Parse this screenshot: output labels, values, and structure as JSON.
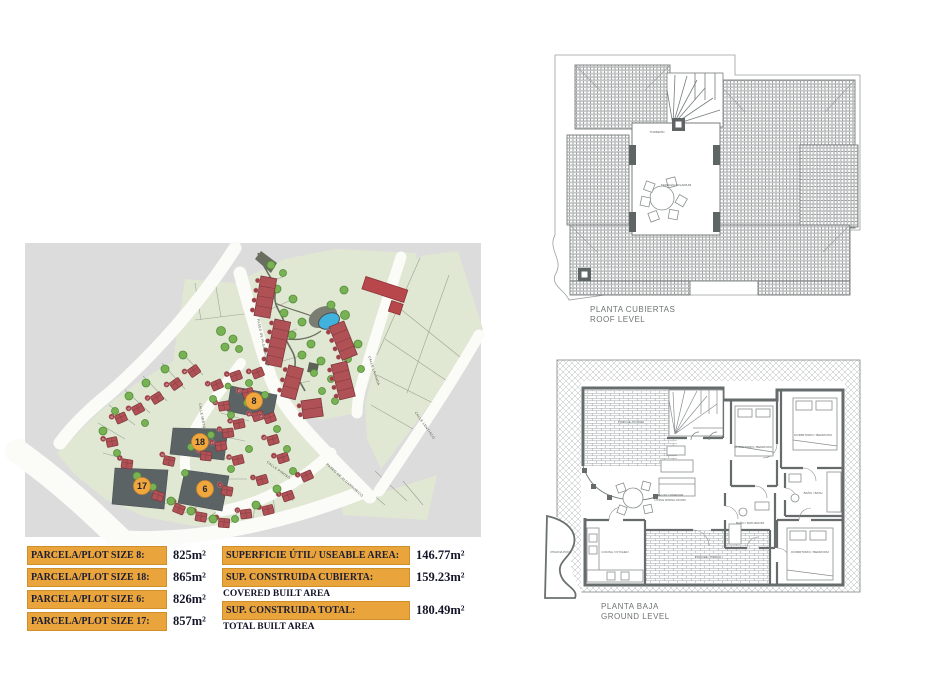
{
  "tables": {
    "plots": {
      "rows": [
        {
          "label": "PARCELA/PLOT SIZE 8:",
          "value": "825m²"
        },
        {
          "label": "PARCELA/PLOT SIZE 18:",
          "value": "865m²"
        },
        {
          "label": "PARCELA/PLOT SIZE 6:",
          "value": "826m²"
        },
        {
          "label": "PARCELA/PLOT SIZE 17:",
          "value": "857m²"
        }
      ]
    },
    "areas": {
      "rows": [
        {
          "label": "SUPERFICIE ÚTIL/ USEABLE AREA:",
          "value": "146.77m²",
          "sublabel": ""
        },
        {
          "label": "SUP. CONSTRUIDA CUBIERTA:",
          "value": "159.23m²",
          "sublabel": "COVERED BUILT AREA"
        },
        {
          "label": "SUP. CONSTRUIDA TOTAL:",
          "value": "180.49m²",
          "sublabel": "TOTAL BUILT AREA"
        }
      ]
    }
  },
  "plans": {
    "roof": {
      "title": "PLANTA CUBIERTAS",
      "subtitle": "ROOF LEVEL",
      "labels": [
        {
          "t": "TORREÓN",
          "x": 112,
          "y": 83
        },
        {
          "t": "TERRAZA SOLARIUM",
          "x": 131,
          "y": 136
        }
      ]
    },
    "ground": {
      "title": "PLANTA BAJA",
      "subtitle": "GROUND LEVEL",
      "rooms": [
        {
          "t": "PORCHE / PORCH",
          "x": 86,
          "y": 75
        },
        {
          "t": "SALON COMEDOR",
          "x": 125,
          "y": 148
        },
        {
          "t": "LIVING DINING ROOM",
          "x": 125,
          "y": 153
        },
        {
          "t": "DORMITORIO / BEDROOM",
          "x": 208,
          "y": 100
        },
        {
          "t": "DORMITORIO / BEDROOM",
          "x": 268,
          "y": 88
        },
        {
          "t": "DORMITORIO / BEDROOM",
          "x": 265,
          "y": 205
        },
        {
          "t": "BAÑO / BATHROOM",
          "x": 205,
          "y": 176
        },
        {
          "t": "BAÑO / BATH",
          "x": 268,
          "y": 146
        },
        {
          "t": "COCINA / KITCHEN",
          "x": 70,
          "y": 205
        },
        {
          "t": "PORCHE / PORCH",
          "x": 163,
          "y": 210
        },
        {
          "t": "PISCINA POOL",
          "x": 16,
          "y": 205
        }
      ]
    }
  },
  "site_map": {
    "colors": {
      "bg": "#dcdcdc",
      "green": "#e0e7d2",
      "road": "#fbfbf8",
      "house": "#b05156",
      "houseStroke": "#7d383d",
      "tree": "#79b254",
      "treeStroke": "#518d37",
      "plotDark": "#5c6365",
      "badge": "#f0a73e",
      "badgeEdge": "#c9862c",
      "badgeText": "#23232f",
      "numCircle": "#9c4046",
      "pool": "#3fb3dd",
      "path": "#6a6e60"
    },
    "streets": [
      {
        "t": "PASEO DE ALGARROBICO",
        "x": 237,
        "y": 100,
        "r": 78
      },
      {
        "t": "PASEO DE ALGARROBICO",
        "x": 319,
        "y": 238,
        "r": 42
      },
      {
        "t": "CALLE LAVANDA",
        "x": 348,
        "y": 128,
        "r": 72
      },
      {
        "t": "CALLE LENTISCO",
        "x": 399,
        "y": 183,
        "r": 55
      },
      {
        "t": "CALLE MIRTO",
        "x": 176,
        "y": 173,
        "r": 80
      },
      {
        "t": "CALLE PINOSO",
        "x": 253,
        "y": 228,
        "r": 36
      }
    ],
    "highlighted_plots": [
      {
        "n": "8",
        "cx": 229,
        "cy": 158,
        "poly": "206,143 252,152 247,177 202,168"
      },
      {
        "n": "18",
        "cx": 175,
        "cy": 199,
        "poly": "148,185 203,186 199,217 145,211"
      },
      {
        "n": "6",
        "cx": 180,
        "cy": 246,
        "poly": "160,227 204,233 197,268 153,260"
      },
      {
        "n": "17",
        "cx": 117,
        "cy": 243,
        "poly": "90,225 143,227 139,266 87,261"
      }
    ],
    "houses": [
      [
        169,
        128,
        -35,
        "26"
      ],
      [
        151,
        141,
        -35,
        "25"
      ],
      [
        132,
        155,
        -32,
        "24"
      ],
      [
        113,
        166,
        -28,
        "23"
      ],
      [
        96,
        175,
        -24,
        "22"
      ],
      [
        87,
        199,
        -12,
        "21"
      ],
      [
        102,
        221,
        8,
        "5"
      ],
      [
        133,
        253,
        18,
        "6"
      ],
      [
        154,
        266,
        22,
        "10"
      ],
      [
        176,
        274,
        10,
        "11"
      ],
      [
        199,
        280,
        4,
        "9"
      ],
      [
        221,
        271,
        -8,
        "27"
      ],
      [
        243,
        267,
        -14,
        "7"
      ],
      [
        263,
        253,
        -20,
        "3"
      ],
      [
        237,
        237,
        -16,
        "2"
      ],
      [
        282,
        233,
        -24,
        "1"
      ],
      [
        213,
        217,
        -14,
        "19"
      ],
      [
        196,
        203,
        -10,
        "13"
      ],
      [
        144,
        218,
        12,
        "16"
      ],
      [
        181,
        213,
        6,
        "18"
      ],
      [
        203,
        190,
        -8,
        "12"
      ],
      [
        214,
        181,
        -12,
        "15"
      ],
      [
        233,
        173,
        -18,
        "14"
      ],
      [
        199,
        163,
        -10,
        "20"
      ],
      [
        211,
        133,
        -20,
        "4"
      ],
      [
        192,
        142,
        -24,
        "17"
      ],
      [
        233,
        130,
        -22,
        "8"
      ],
      [
        245,
        175,
        -20,
        "14"
      ],
      [
        248,
        197,
        -16,
        "19"
      ],
      [
        258,
        215,
        -18,
        "2"
      ],
      [
        223,
        150,
        -16,
        "13"
      ],
      [
        202,
        248,
        10,
        "4"
      ]
    ],
    "trees": [
      [
        158,
        112,
        4
      ],
      [
        140,
        126,
        4
      ],
      [
        121,
        140,
        4
      ],
      [
        104,
        153,
        4
      ],
      [
        90,
        168,
        3.5
      ],
      [
        78,
        188,
        4
      ],
      [
        92,
        210,
        3.5
      ],
      [
        112,
        233,
        4
      ],
      [
        128,
        244,
        3.5
      ],
      [
        146,
        258,
        4
      ],
      [
        166,
        268,
        4
      ],
      [
        188,
        276,
        4
      ],
      [
        210,
        276,
        3.5
      ],
      [
        231,
        262,
        4
      ],
      [
        252,
        246,
        4
      ],
      [
        268,
        228,
        3.5
      ],
      [
        224,
        206,
        3.5
      ],
      [
        206,
        226,
        3.5
      ],
      [
        186,
        192,
        3.5
      ],
      [
        166,
        204,
        3.5
      ],
      [
        206,
        172,
        3.5
      ],
      [
        188,
        156,
        3.5
      ],
      [
        222,
        160,
        3.5
      ],
      [
        240,
        152,
        3.5
      ],
      [
        224,
        140,
        3.5
      ],
      [
        252,
        186,
        3.5
      ],
      [
        262,
        206,
        3.5
      ],
      [
        203,
        143,
        3
      ],
      [
        160,
        230,
        3.5
      ],
      [
        120,
        180,
        3.5
      ],
      [
        196,
        88,
        4.5
      ],
      [
        208,
        96,
        4
      ],
      [
        200,
        104,
        4
      ],
      [
        214,
        106,
        3.5
      ],
      [
        246,
        22,
        4
      ],
      [
        258,
        30,
        3.5
      ],
      [
        252,
        46,
        4
      ],
      [
        268,
        56,
        4
      ],
      [
        259,
        70,
        4
      ],
      [
        277,
        79,
        4
      ],
      [
        267,
        92,
        4
      ],
      [
        286,
        101,
        4
      ],
      [
        277,
        112,
        4
      ],
      [
        296,
        118,
        4
      ],
      [
        289,
        130,
        3.5
      ],
      [
        306,
        136,
        3.5
      ],
      [
        297,
        148,
        3.5
      ],
      [
        312,
        92,
        4
      ],
      [
        320,
        72,
        4.5
      ],
      [
        306,
        62,
        4
      ],
      [
        319,
        47,
        4
      ],
      [
        333,
        101,
        4
      ],
      [
        323,
        116,
        3.5
      ],
      [
        336,
        126,
        3.5
      ],
      [
        291,
        160,
        3.5
      ],
      [
        310,
        158,
        3.5
      ]
    ],
    "park_rows": [
      {
        "x": 236,
        "y": 33,
        "rot": 10,
        "w": 16,
        "h": 40,
        "u": 4
      },
      {
        "x": 250,
        "y": 76,
        "rot": 12,
        "w": 16,
        "h": 46,
        "u": 5
      },
      {
        "x": 264,
        "y": 122,
        "rot": 15,
        "w": 15,
        "h": 32,
        "u": 3
      },
      {
        "x": 304,
        "y": 84,
        "rot": -22,
        "w": 16,
        "h": 36,
        "u": 4
      },
      {
        "x": 306,
        "y": 122,
        "rot": -14,
        "w": 16,
        "h": 36,
        "u": 4
      },
      {
        "x": 276,
        "y": 158,
        "rot": -8,
        "w": 20,
        "h": 18,
        "u": 2
      }
    ]
  }
}
